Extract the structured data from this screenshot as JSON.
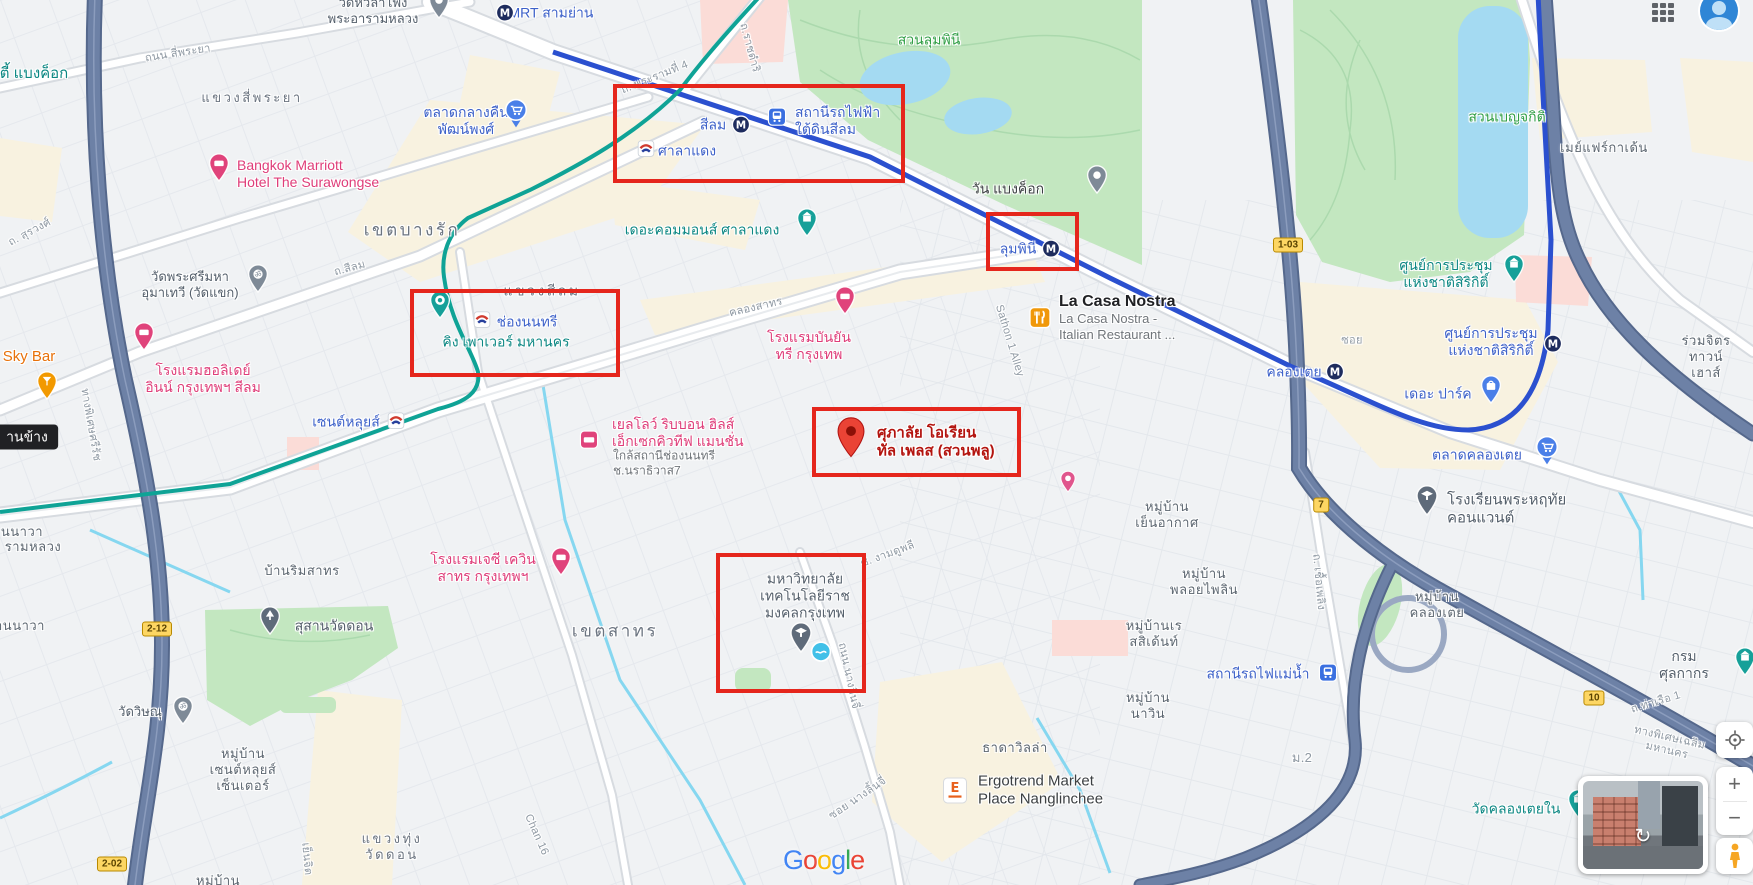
{
  "annotations": {
    "color": "#e5261c",
    "boxes": [
      {
        "name": "annotation-box-silom-station",
        "x": 613,
        "y": 84,
        "w": 292,
        "h": 99
      },
      {
        "name": "annotation-box-lumphini-station",
        "x": 986,
        "y": 212,
        "w": 93,
        "h": 59
      },
      {
        "name": "annotation-box-chong-nonsi",
        "x": 410,
        "y": 289,
        "w": 210,
        "h": 88
      },
      {
        "name": "annotation-box-supalai-pin",
        "x": 812,
        "y": 407,
        "w": 209,
        "h": 70
      },
      {
        "name": "annotation-box-university",
        "x": 716,
        "y": 553,
        "w": 150,
        "h": 140
      }
    ]
  },
  "map": {
    "labels": [
      {
        "n": "label-mrt-sam-yan",
        "t": "MRT สามย่าน",
        "x": 551,
        "y": 13,
        "c": "poi-blue",
        "in": true
      },
      {
        "n": "label-silom-mrt",
        "t": "สีลม",
        "x": 713,
        "y": 125,
        "c": "poi-blue",
        "in": true
      },
      {
        "n": "label-silom-underground-station",
        "t": "สถานีรถไฟฟ้า\nใต้ดินสีลม",
        "x": 795,
        "y": 121,
        "c": "poi-blue left",
        "ax": "l",
        "in": true
      },
      {
        "n": "label-sala-daeng-bts",
        "t": "ศาลาแดง",
        "x": 687,
        "y": 151,
        "c": "poi-blue",
        "in": true
      },
      {
        "n": "label-chong-nonsi-bts",
        "t": "ช่องนนทรี",
        "x": 527,
        "y": 322,
        "c": "poi-blue",
        "in": true
      },
      {
        "n": "label-saint-louis-bts",
        "t": "เซนต์หลุยส์",
        "x": 346,
        "y": 422,
        "c": "poi-blue",
        "in": true
      },
      {
        "n": "label-lumphini-mrt",
        "t": "ลุมพินี",
        "x": 1018,
        "y": 249,
        "c": "poi-blue",
        "in": true
      },
      {
        "n": "label-khlong-toei-mrt",
        "t": "คลองเตย",
        "x": 1294,
        "y": 372,
        "c": "poi-blue",
        "in": true
      },
      {
        "n": "label-sirikit-center-mrt",
        "t": "ศูนย์การประชุม\nแห่งชาติสิริกิติ์",
        "x": 1491,
        "y": 342,
        "c": "poi-blue",
        "in": true
      },
      {
        "n": "label-the-parq",
        "t": "เดอะ ปาร์ค",
        "x": 1438,
        "y": 394,
        "c": "poi-blue",
        "in": true
      },
      {
        "n": "label-khlong-toei-market",
        "t": "ตลาดคลองเตย",
        "x": 1477,
        "y": 455,
        "c": "poi-blue",
        "in": true
      },
      {
        "n": "label-patpong-night-market",
        "t": "ตลาดกลางคืน\nพัฒน์พงศ์",
        "x": 466,
        "y": 121,
        "c": "poi-blue",
        "in": true
      },
      {
        "n": "label-mae-nam-railway-station",
        "t": "สถานีรถไฟแม่น้ำ",
        "x": 1258,
        "y": 674,
        "c": "poi-blue",
        "in": true
      },
      {
        "n": "label-the-commons-saladaeng",
        "t": "เดอะคอมมอนส์ ศาลาแดง",
        "x": 702,
        "y": 230,
        "c": "poi-teal",
        "in": true
      },
      {
        "n": "label-king-power-mahanakhon",
        "t": "คิง เพาเวอร์ มหานคร",
        "x": 506,
        "y": 342,
        "c": "poi-teal",
        "in": true
      },
      {
        "n": "label-sirikit-convention-center",
        "t": "ศูนย์การประชุม\nแห่งชาติสิริกิติ์",
        "x": 1446,
        "y": 274,
        "c": "poi-teal",
        "in": true
      },
      {
        "n": "label-wat-khlong-toei-nai",
        "t": "วัดคลองเตยใน",
        "x": 1516,
        "y": 809,
        "c": "poi-teal",
        "in": true
      },
      {
        "n": "label-customs-department",
        "t": "กรมศุลกากร",
        "x": 1684,
        "y": 665,
        "c": "poi-gray",
        "s": 14,
        "in": true
      },
      {
        "n": "label-lumphini-park",
        "t": "สวนลุมพินี",
        "x": 929,
        "y": 40,
        "c": "park",
        "in": true
      },
      {
        "n": "label-benjakitti-park",
        "t": "สวนเบญจกิติ",
        "x": 1507,
        "y": 117,
        "c": "park",
        "in": true
      },
      {
        "n": "label-sacred-heart-convent-school",
        "t": "โรงเรียนพระหฤทัย\nคอนแวนต์",
        "x": 1447,
        "y": 510,
        "c": "poi-gray left",
        "ax": "l",
        "s": 15,
        "in": true
      },
      {
        "n": "label-wat-khaek",
        "t": "วัดพระศรีมหา\nอุมาเทวี (วัดแขก)",
        "x": 190,
        "y": 285,
        "c": "poi-gray",
        "in": true
      },
      {
        "n": "label-wat-hua-lamphong",
        "t": "วัดหัวลำโพง\nพระอารามหลวง",
        "x": 373,
        "y": 11,
        "c": "poi-gray",
        "in": true
      },
      {
        "n": "label-wat-don-cemetery",
        "t": "สุสานวัดดอน",
        "x": 334,
        "y": 626,
        "c": "poi-gray",
        "s": 14,
        "in": true
      },
      {
        "n": "label-wat-vishnu",
        "t": "วัดวิษณุ",
        "x": 140,
        "y": 712,
        "c": "poi-gray",
        "in": true
      },
      {
        "n": "label-rmutk-university",
        "t": "มหาวิทยาลัย\nเทคโนโลยีราช\nมงคลกรุงเทพ",
        "x": 805,
        "y": 596,
        "c": "poi-gray",
        "s": 14,
        "in": true
      },
      {
        "n": "label-la-casa-nostra-title",
        "t": "La Casa Nostra",
        "x": 1059,
        "y": 302,
        "c": "poi-title left",
        "ax": "l",
        "in": true
      },
      {
        "n": "label-la-casa-nostra-sub",
        "t": "La Casa Nostra -\nItalian Restaurant ...",
        "x": 1059,
        "y": 327,
        "c": "sub left",
        "ax": "l",
        "s": 13,
        "in": true
      },
      {
        "n": "label-ergotrend-market",
        "t": "Ergotrend Market\nPlace Nanglinchee",
        "x": 978,
        "y": 791,
        "c": "poi-dark left",
        "ax": "l",
        "s": 15,
        "in": true
      },
      {
        "n": "label-bangkok-marriott",
        "t": "Bangkok Marriott\nHotel The Surawongse",
        "x": 237,
        "y": 174,
        "c": "poi-pink left",
        "ax": "l",
        "in": true
      },
      {
        "n": "label-holiday-inn-silom",
        "t": "โรงแรมฮอลิเดย์\nอินน์ กรุงเทพฯ สีลม",
        "x": 203,
        "y": 379,
        "c": "poi-pink",
        "in": true
      },
      {
        "n": "label-banyan-tree-hotel",
        "t": "โรงแรมบันยัน\nทรี กรุงเทพ",
        "x": 809,
        "y": 346,
        "c": "poi-pink",
        "in": true
      },
      {
        "n": "label-jc-kevin-sathorn-hotel",
        "t": "โรงแรมเจซี เควิน\nสาทร กรุงเทพฯ",
        "x": 483,
        "y": 568,
        "c": "poi-pink",
        "in": true
      },
      {
        "n": "label-yellow-ribbon-hills",
        "t": "เยลโลว์ ริบบอน ฮิลส์\nเอ็กเซกคิวทีฟ แมนชั่น",
        "x": 612,
        "y": 433,
        "c": "poi-pink left",
        "ax": "l",
        "in": true
      },
      {
        "n": "label-yellow-ribbon-sub",
        "t": "ใกล้สถานีช่องนนทรี\nช.นราธิวาส7",
        "x": 613,
        "y": 463,
        "c": "sub left",
        "ax": "l",
        "in": true
      },
      {
        "n": "label-sky-bar",
        "t": "Sky Bar",
        "x": 29,
        "y": 357,
        "c": "poi-orange",
        "in": true
      },
      {
        "n": "label-supalai-oriental-place",
        "t": "ศุภาลัย โอเรียน\nทัล เพลส (สวนพลู)",
        "x": 877,
        "y": 443,
        "c": "poi-red left",
        "ax": "l",
        "in": true
      },
      {
        "n": "label-one-bangkok",
        "t": "วัน แบงค็อก",
        "x": 1008,
        "y": 189,
        "c": "poi-dark",
        "s": 14,
        "in": true
      },
      {
        "n": "label-mayfair-garden",
        "t": "เมย์แฟร์กาเด้น",
        "x": 1604,
        "y": 148,
        "c": "area",
        "in": false
      },
      {
        "n": "label-ruamchit-townhouse",
        "t": "ร่วมจิตร\nทาวน์เฮาส์",
        "x": 1706,
        "y": 357,
        "c": "area",
        "in": false
      },
      {
        "n": "label-mooban-yen-akat",
        "t": "หมู่บ้าน\nเย็นอากาศ",
        "x": 1167,
        "y": 515,
        "c": "area",
        "in": false
      },
      {
        "n": "label-mooban-ploy-pailin",
        "t": "หมู่บ้าน\nพลอยไพลิน",
        "x": 1204,
        "y": 582,
        "c": "area",
        "in": false
      },
      {
        "n": "label-mooban-residence",
        "t": "หมู่บ้านเร\nสสิเด้นท์",
        "x": 1154,
        "y": 634,
        "c": "area",
        "in": false
      },
      {
        "n": "label-mooban-nawin",
        "t": "หมู่บ้าน\nนาวิน",
        "x": 1148,
        "y": 706,
        "c": "area",
        "in": false
      },
      {
        "n": "label-mooban-khlong-toei",
        "t": "หมู่บ้าน\nคลองเตย",
        "x": 1437,
        "y": 605,
        "c": "area",
        "in": false
      },
      {
        "n": "label-thada-villa",
        "t": "ธาดาวิลล่า",
        "x": 1015,
        "y": 748,
        "c": "area",
        "in": false
      },
      {
        "n": "label-baan-rim-sathorn",
        "t": "บ้านริมสาทร",
        "x": 302,
        "y": 571,
        "c": "area",
        "in": false
      },
      {
        "n": "label-mooban-saint-louis-center",
        "t": "หมู่บ้าน\nเซนต์หลุยส์\nเซ็นเตอร์",
        "x": 243,
        "y": 770,
        "c": "area",
        "in": false
      },
      {
        "n": "label-khwaeng-thung-wat-don",
        "t": "แขวงทุ่ง\nวัดดอน",
        "x": 392,
        "y": 847,
        "c": "district",
        "s": 13,
        "in": false
      },
      {
        "n": "label-khet-bang-rak",
        "t": "เขตบางรัก",
        "x": 412,
        "y": 231,
        "c": "district",
        "s": 17,
        "in": false
      },
      {
        "n": "label-khwaeng-silom",
        "t": "แขวงสีลม",
        "x": 542,
        "y": 291,
        "c": "district",
        "s": 14,
        "in": false
      },
      {
        "n": "label-khwaeng-si-phraya",
        "t": "แขวงสี่พระยา",
        "x": 252,
        "y": 98,
        "c": "district",
        "s": 13,
        "in": false
      },
      {
        "n": "label-khet-sathorn",
        "t": "เขตสาทร",
        "x": 615,
        "y": 632,
        "c": "district",
        "s": 17,
        "in": false
      },
      {
        "n": "label-rama4-road",
        "t": "ถ. พระรามที่ 4",
        "x": 655,
        "y": 78,
        "c": "road",
        "r": -22,
        "in": false
      },
      {
        "n": "label-si-phraya-road",
        "t": "ถนน สี่พระยา",
        "x": 178,
        "y": 54,
        "c": "road",
        "r": -9,
        "in": false
      },
      {
        "n": "label-surawong-road",
        "t": "ถ. สุรวงศ์",
        "x": 30,
        "y": 233,
        "c": "road",
        "r": -28,
        "in": false
      },
      {
        "n": "label-silom-road",
        "t": "ถ.สีลม",
        "x": 350,
        "y": 269,
        "c": "road",
        "r": -15,
        "in": false
      },
      {
        "n": "label-khlong-sathorn",
        "t": "คลองสาทร",
        "x": 756,
        "y": 308,
        "c": "road",
        "r": -13,
        "in": false
      },
      {
        "n": "label-sathon-1-alley",
        "t": "Sathon 1 Alley",
        "x": 1009,
        "y": 341,
        "c": "road",
        "r": 73,
        "in": false
      },
      {
        "n": "label-soi-ngam-duphli",
        "t": "ซ. งามดูพลี",
        "x": 888,
        "y": 555,
        "c": "road",
        "r": -20,
        "in": false
      },
      {
        "n": "label-nanglinchee-road",
        "t": "ถนน นางลิ้นจี่",
        "x": 848,
        "y": 676,
        "c": "road",
        "r": 78,
        "in": false
      },
      {
        "n": "label-soi-nanglinchee",
        "t": "ซอย นางลิ้นจี่",
        "x": 858,
        "y": 799,
        "c": "road",
        "r": -34,
        "in": false
      },
      {
        "n": "label-chan-16",
        "t": "Chan 16",
        "x": 536,
        "y": 835,
        "c": "road",
        "r": 66,
        "in": false
      },
      {
        "n": "label-chuea-phloeng-road",
        "t": "ถ. เชื้อเพลิง",
        "x": 1318,
        "y": 582,
        "c": "road",
        "r": 85,
        "in": false
      },
      {
        "n": "label-tha-ruea-1-road",
        "t": "ถ.ท่าเรือ 1",
        "x": 1656,
        "y": 703,
        "c": "road",
        "r": -17,
        "in": false
      },
      {
        "n": "label-chalerm-maha-nakhon-expy",
        "t": "ทางพิเศษเฉลิมมหานคร",
        "x": 1668,
        "y": 745,
        "c": "road",
        "r": 13,
        "in": false
      },
      {
        "n": "label-si-rat-expy",
        "t": "ทางพิเศษศรีรัช",
        "x": 90,
        "y": 425,
        "c": "road",
        "r": 80,
        "in": false
      },
      {
        "n": "label-soi",
        "t": "ซอย",
        "x": 1352,
        "y": 341,
        "c": "road",
        "in": false
      },
      {
        "n": "label-mu-2",
        "t": "ม.2",
        "x": 1302,
        "y": 758,
        "c": "road",
        "s": 13,
        "in": false
      },
      {
        "n": "label-yen-chit",
        "t": "เย็นจิต",
        "x": 306,
        "y": 859,
        "c": "road",
        "r": 85,
        "in": false
      },
      {
        "n": "label-ratchadamri-road",
        "t": "ถ.ราชดำริ",
        "x": 749,
        "y": 48,
        "c": "road",
        "r": 75,
        "in": false
      },
      {
        "n": "label-edge-partial-bangkok",
        "t": "ตี้ แบงค็อก",
        "x": 34,
        "y": 74,
        "c": "poi-teal",
        "s": 15,
        "in": false
      },
      {
        "n": "label-edge-partial-nawa",
        "t": "นนาวา",
        "x": 22,
        "y": 532,
        "c": "area",
        "in": false
      },
      {
        "n": "label-edge-partial-ram-luang",
        "t": "รามหลวง",
        "x": 33,
        "y": 547,
        "c": "area",
        "in": false
      },
      {
        "n": "label-edge-partial-an-nawa",
        "t": "านนาวา",
        "x": 20,
        "y": 626,
        "c": "area",
        "in": false
      },
      {
        "n": "label-edge-partial-mooban",
        "t": "หมู่บ้าน",
        "x": 218,
        "y": 881,
        "c": "area",
        "in": false
      },
      {
        "n": "map-tooltip",
        "t": "านข้าง",
        "x": 27,
        "y": 437,
        "c": "tooltip",
        "in": false
      }
    ],
    "icons": [
      {
        "n": "mrt-logo-icon",
        "t": "m",
        "x": 505,
        "y": 13
      },
      {
        "n": "mrt-logo-icon",
        "t": "m",
        "x": 741,
        "y": 125
      },
      {
        "n": "subway-station-icon",
        "t": "train",
        "x": 777,
        "y": 117
      },
      {
        "n": "bts-logo-icon",
        "t": "bts",
        "x": 646,
        "y": 149
      },
      {
        "n": "bts-logo-icon",
        "t": "bts",
        "x": 482,
        "y": 320
      },
      {
        "n": "bts-logo-icon",
        "t": "bts",
        "x": 396,
        "y": 421
      },
      {
        "n": "mrt-logo-icon",
        "t": "m",
        "x": 1051,
        "y": 249
      },
      {
        "n": "mrt-logo-icon",
        "t": "m",
        "x": 1335,
        "y": 372
      },
      {
        "n": "mrt-logo-icon",
        "t": "m",
        "x": 1553,
        "y": 344
      },
      {
        "n": "shopping-bag-pin-icon",
        "t": "bag",
        "x": 1491,
        "y": 390
      },
      {
        "n": "shopping-cart-pin-icon",
        "t": "cart",
        "x": 1547,
        "y": 451
      },
      {
        "n": "shopping-cart-pin-icon",
        "t": "cart",
        "x": 516,
        "y": 114
      },
      {
        "n": "railway-station-icon",
        "t": "train",
        "x": 1328,
        "y": 673
      },
      {
        "n": "landmark-pin-icon",
        "t": "landmark",
        "x": 807,
        "y": 223
      },
      {
        "n": "camera-pin-icon",
        "t": "camera",
        "x": 440,
        "y": 305
      },
      {
        "n": "landmark-pin-icon",
        "t": "landmark",
        "x": 1514,
        "y": 269
      },
      {
        "n": "landmark-pin-icon",
        "t": "landmark",
        "x": 1578,
        "y": 804
      },
      {
        "n": "landmark-pin-icon",
        "t": "landmark",
        "x": 1745,
        "y": 662
      },
      {
        "n": "school-pin-icon",
        "t": "grad",
        "x": 1427,
        "y": 501
      },
      {
        "n": "temple-pin-icon",
        "t": "om",
        "x": 258,
        "y": 279
      },
      {
        "n": "temple-pin-icon",
        "t": "gray",
        "x": 439,
        "y": 5
      },
      {
        "n": "cemetery-pin-icon",
        "t": "tree",
        "x": 270,
        "y": 621
      },
      {
        "n": "temple-pin-icon",
        "t": "om",
        "x": 183,
        "y": 711
      },
      {
        "n": "university-pin-icon",
        "t": "grad",
        "x": 801,
        "y": 638
      },
      {
        "n": "pool-dot-icon",
        "t": "dot",
        "x": 821,
        "y": 652
      },
      {
        "n": "restaurant-square-icon",
        "t": "fork",
        "x": 1040,
        "y": 318
      },
      {
        "n": "ergotrend-logo-icon",
        "t": "esq",
        "x": 955,
        "y": 791
      },
      {
        "n": "hotel-pin-icon",
        "t": "bed",
        "x": 219,
        "y": 168
      },
      {
        "n": "hotel-pin-icon",
        "t": "bed",
        "x": 144,
        "y": 337
      },
      {
        "n": "hotel-pin-icon",
        "t": "bed",
        "x": 845,
        "y": 301
      },
      {
        "n": "hotel-pin-icon",
        "t": "bed",
        "x": 561,
        "y": 562
      },
      {
        "n": "hotel-square-icon",
        "t": "bedsq",
        "x": 589,
        "y": 440
      },
      {
        "n": "bar-pin-icon",
        "t": "wine",
        "x": 47,
        "y": 386
      },
      {
        "n": "destination-pin-icon",
        "t": "redpin",
        "x": 851,
        "y": 438
      },
      {
        "n": "small-pink-pin-icon",
        "t": "pinksm",
        "x": 1068,
        "y": 482
      },
      {
        "n": "place-pin-icon",
        "t": "gray",
        "x": 1097,
        "y": 180
      }
    ],
    "shields": [
      {
        "n": "route-shield",
        "t": "2-12",
        "x": 157,
        "y": 629
      },
      {
        "n": "route-shield",
        "t": "2-02",
        "x": 112,
        "y": 864
      },
      {
        "n": "route-shield",
        "t": "1-03",
        "x": 1288,
        "y": 245
      },
      {
        "n": "route-shield",
        "t": "7",
        "x": 1321,
        "y": 505
      },
      {
        "n": "route-shield",
        "t": "10",
        "x": 1594,
        "y": 698
      }
    ],
    "colors": {
      "annotation_red": "#e5261c",
      "mrt_line": "#2b50cf",
      "bts_line": "#0fa396",
      "expressway": "#6d81a6",
      "park": "#c3e7c0",
      "water": "#a4daf2"
    }
  },
  "controls": {
    "zoom_in_label": "+",
    "zoom_out_label": "−",
    "streetview_arrow": "↻"
  },
  "google_logo": {
    "letters": [
      {
        "ch": "G",
        "color": "#4285F4"
      },
      {
        "ch": "o",
        "color": "#EA4335"
      },
      {
        "ch": "o",
        "color": "#FBBC05"
      },
      {
        "ch": "g",
        "color": "#4285F4"
      },
      {
        "ch": "l",
        "color": "#34A853"
      },
      {
        "ch": "e",
        "color": "#EA4335"
      }
    ]
  }
}
